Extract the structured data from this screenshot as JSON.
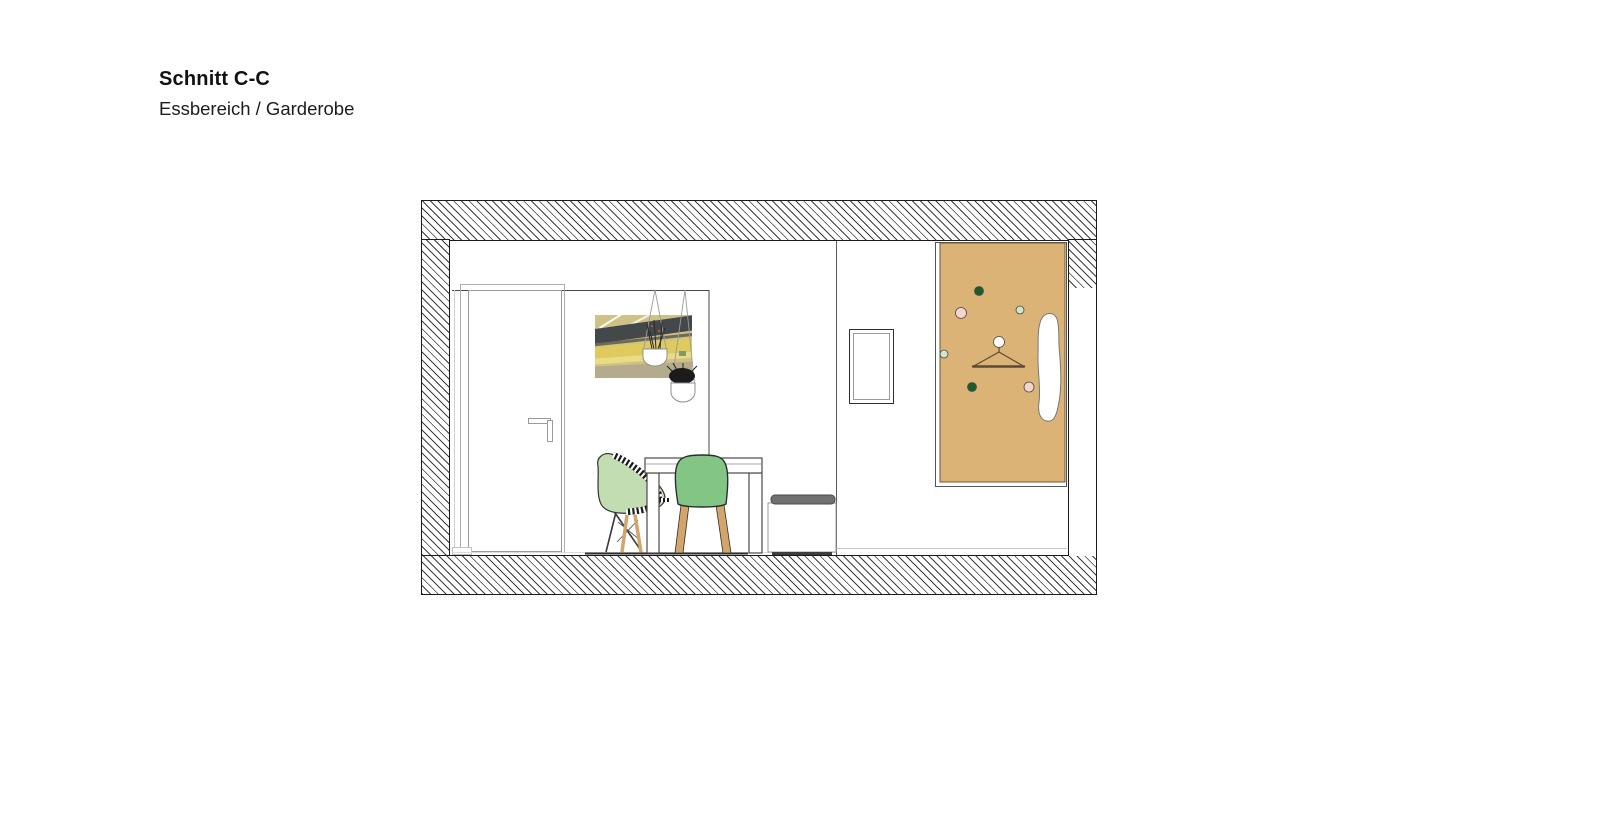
{
  "title_block": {
    "title": "Schnitt C-C",
    "subtitle": "Essbereich / Garderobe"
  },
  "drawing": {
    "label": "Architectural section: dining area and wardrobe",
    "colors": {
      "panel_tan": "#dcb377",
      "chair_solid_green": "#82c585",
      "chair_shell_green": "#c3ddb3",
      "wood": "#d2a56a",
      "peg_dark_green": "#1d5c2a",
      "peg_pink": "#f3d5cd",
      "peg_mint": "#cfe6cb",
      "peg_white": "#ffffff",
      "cushion_gray": "#707070"
    }
  }
}
